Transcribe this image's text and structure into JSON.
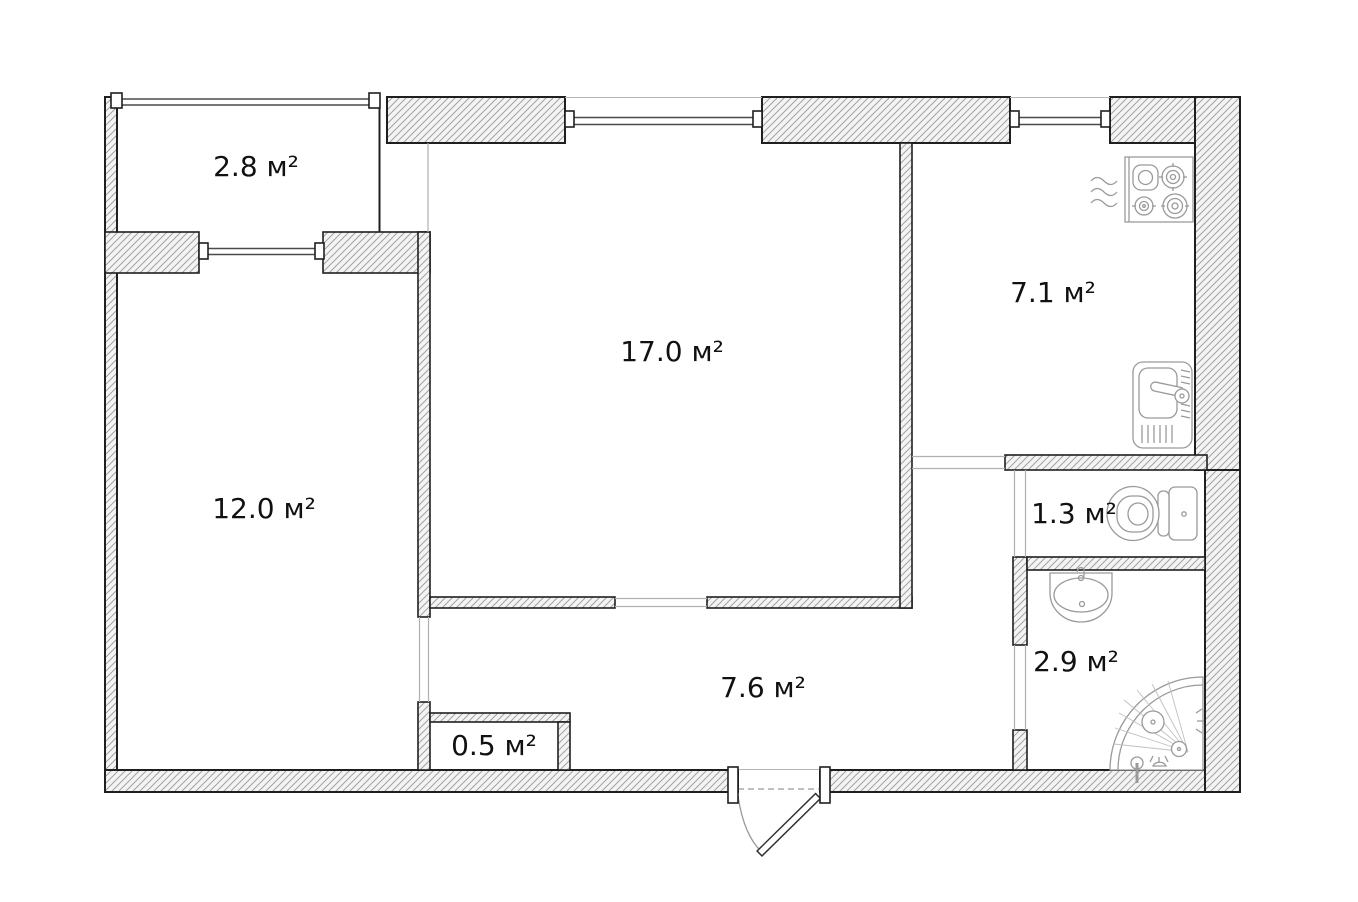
{
  "plan": {
    "rooms": [
      {
        "name": "balcony",
        "area_label": "2.8 м²"
      },
      {
        "name": "living-room",
        "area_label": "17.0 м²"
      },
      {
        "name": "kitchen",
        "area_label": "7.1 м²"
      },
      {
        "name": "bedroom",
        "area_label": "12.0 м²"
      },
      {
        "name": "wc",
        "area_label": "1.3 м²"
      },
      {
        "name": "bathroom",
        "area_label": "2.9 м²"
      },
      {
        "name": "hallway",
        "area_label": "7.6 м²"
      },
      {
        "name": "closet",
        "area_label": "0.5 м²"
      }
    ],
    "fixtures": [
      "stove-icon",
      "steam-icon",
      "kitchen-sink-icon",
      "toilet-icon",
      "washbasin-icon",
      "corner-shower-icon",
      "entry-door-icon",
      "window-icon"
    ],
    "colors": {
      "background": "#ffffff",
      "wall_outline": "#1f1f1f",
      "hatch_line": "#a3a3a3",
      "hatch_fill": "#f4f4f4",
      "fixture_line": "#9a9a9a",
      "label_text": "#111111"
    }
  }
}
